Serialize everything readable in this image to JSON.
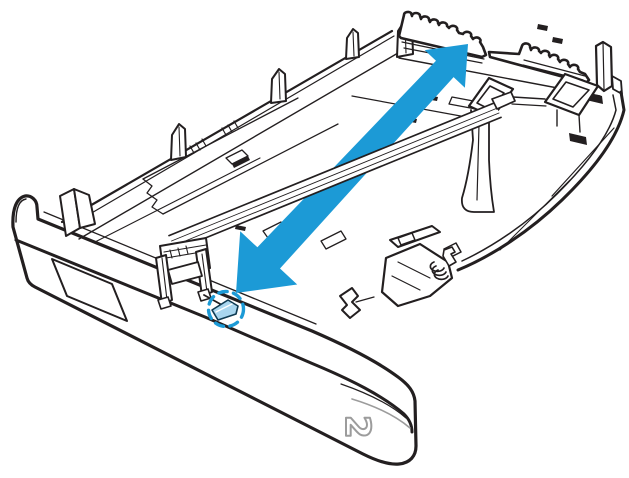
{
  "figure": {
    "kind": "printer-paper-tray-illustration",
    "tray_label": "2",
    "caption_semantics": "Open paper tray with two-headed arrow showing extend/retract direction; dashed circle highlights blue length-guide latch tab",
    "arrow_direction": "diagonal double-headed, lower-left to upper-right"
  },
  "colors": {
    "ink": "#231f20",
    "accent": "#1c9ad6",
    "tab": "#a9d6ef",
    "tab_edge": "#0e3a52",
    "muted": "#9c9c9c"
  }
}
